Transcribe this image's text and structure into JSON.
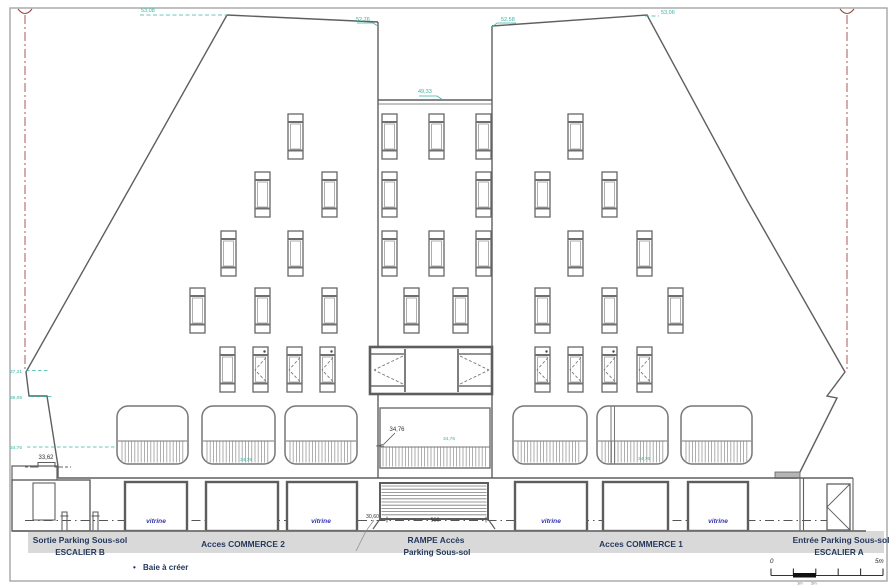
{
  "colors": {
    "teal_annotation": "#38b2a3",
    "centerline_red": "#a04848",
    "label_navy": "#24385c",
    "vitrine_blue": "#3434ae",
    "ground_band_gray": "#d9d9d9",
    "line_gray": "#5f5f5f"
  },
  "ground_labels": {
    "sortie_line1": "Sortie Parking Sous-sol",
    "sortie_line2": "ESCALIER B",
    "commerce2": "Acces COMMERCE 2",
    "rampe_line1": "RAMPE Accès",
    "rampe_line2": "Parking Sous-sol",
    "commerce1": "Acces COMMERCE 1",
    "entree_line1": "Entrée Parking Sous-sol",
    "entree_line2": "ESCALIER A"
  },
  "legend": {
    "bullet": "•",
    "label": "Baie à créer"
  },
  "vitrine": "vitrine",
  "scale_bar": {
    "zero": "0",
    "five": "5m",
    "sub1": "1m",
    "sub2": "2m"
  },
  "dimensions": {
    "d33_62": "33,62",
    "d34_76": "34,76",
    "d30_60": "30,60",
    "d500": "500"
  },
  "levels": {
    "roof_left_line": "53,08",
    "notch_left": "52,76",
    "notch_right": "52,58",
    "roof_right": "53,06",
    "center_parapet": "49,33",
    "edge_upper": "37,21",
    "edge_mid": "36,05",
    "edge_lower": "34,76",
    "balcony_left": "34,76",
    "balcony_center": "34,76",
    "balcony_right": "34,76"
  }
}
